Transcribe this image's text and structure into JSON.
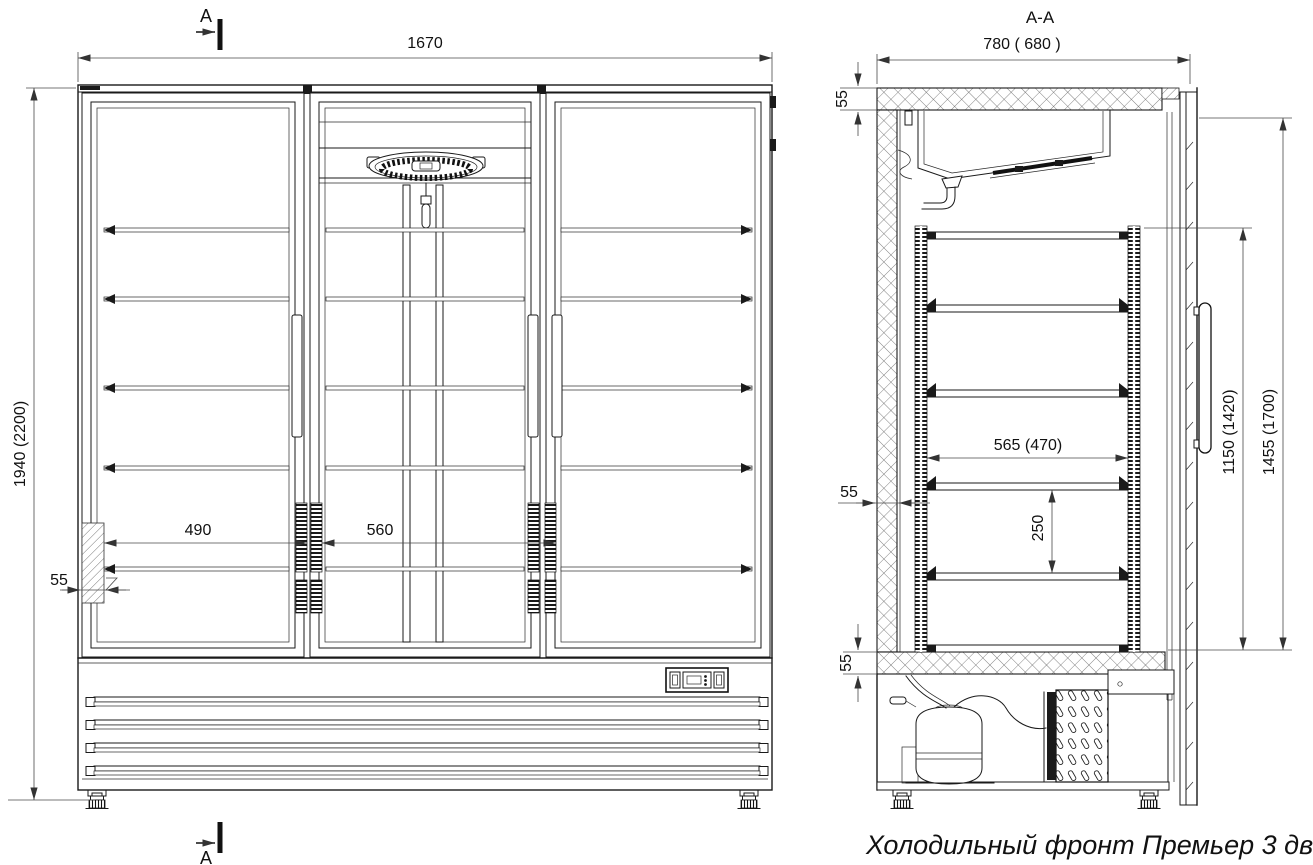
{
  "page": {
    "background": "#ffffff",
    "line_color": "#1a1a1a"
  },
  "caption": "Холодильный фронт Премьер 3 двери.",
  "cut_markers": {
    "top": "A",
    "bottom": "A"
  },
  "front_view": {
    "total_width": "1670",
    "total_height": "1940 (2200)",
    "left_bay_width": "490",
    "center_bay_width": "560",
    "wall_thickness": "55"
  },
  "section_view": {
    "label": "A-A",
    "total_depth": "780 ( 680 )",
    "top_panel_thickness": "55",
    "side_wall_thickness": "55",
    "bottom_panel_thickness": "55",
    "shelf_depth": "565 (470)",
    "shelf_spacing": "250",
    "inner_height": "1150 (1420)",
    "door_opening_height": "1455 (1700)"
  }
}
